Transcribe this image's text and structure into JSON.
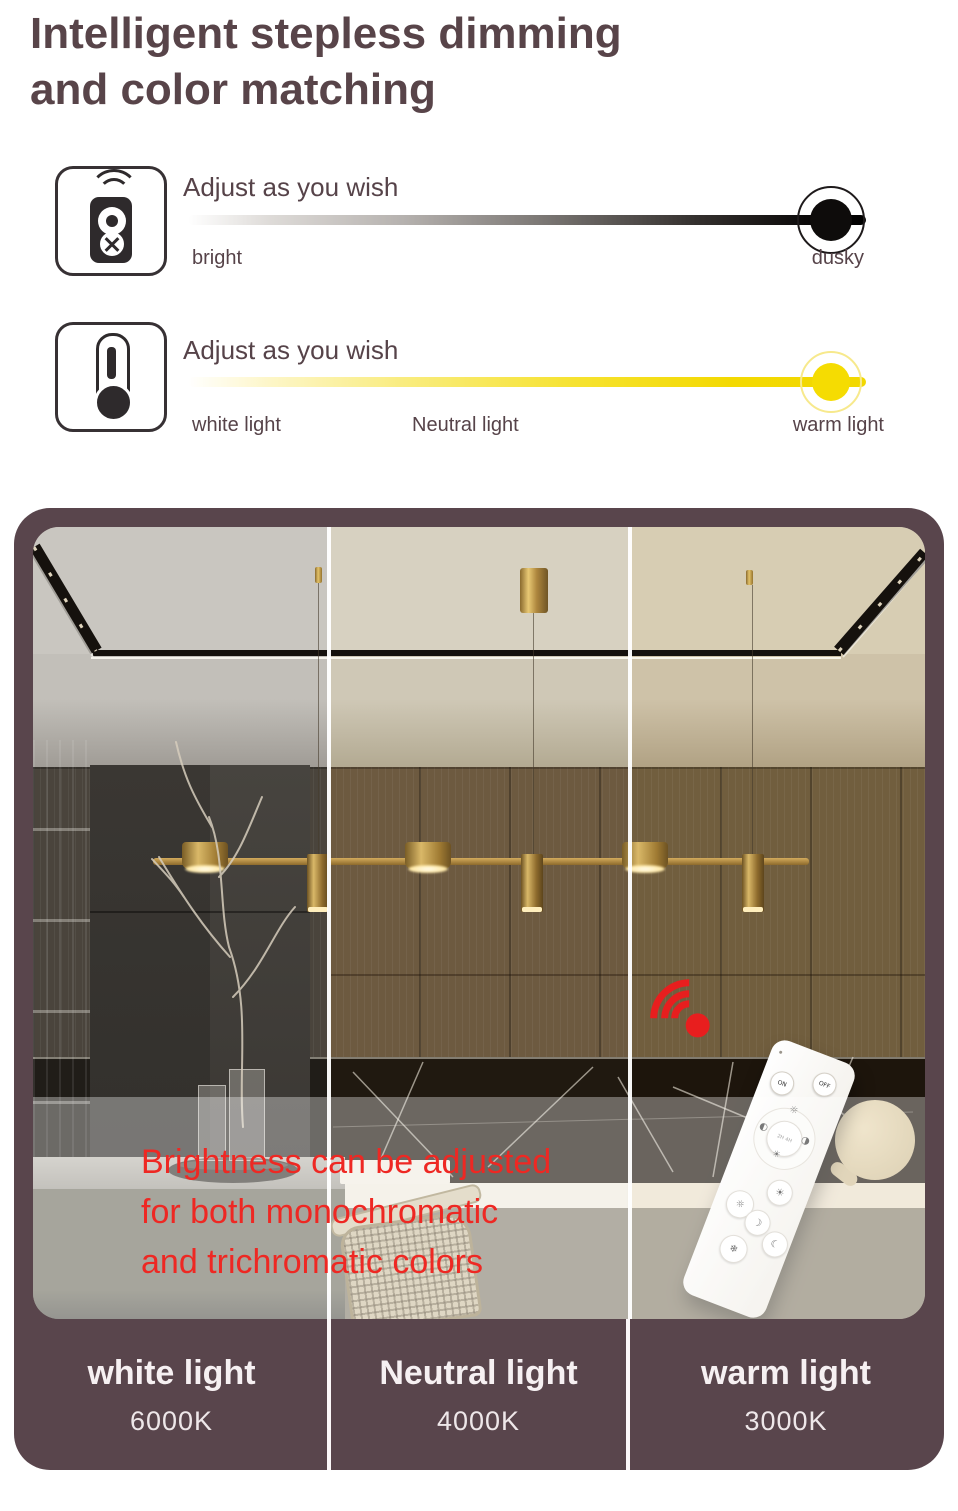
{
  "title": {
    "line1": "Intelligent stepless dimming",
    "line2": "and color matching"
  },
  "dimming_row": {
    "label": "Adjust as you wish",
    "left_label": "bright",
    "right_label": "dusky"
  },
  "color_temp_row": {
    "label": "Adjust as you wish",
    "left_label": "white light",
    "mid_label": "Neutral light",
    "right_label": "warm light"
  },
  "photo": {
    "caption_line1": "Brightness can be adjusted",
    "caption_line2": "for both monochromatic",
    "caption_line3": "and trichromatic colors",
    "remote": {
      "on": "ON",
      "off": "OFF",
      "timer": "2H 4H"
    }
  },
  "columns": [
    {
      "name": "white light",
      "kelvin": "6000K"
    },
    {
      "name": "Neutral light",
      "kelvin": "4000K"
    },
    {
      "name": "warm light",
      "kelvin": "3000K"
    }
  ],
  "colors": {
    "title_text": "#584449",
    "accent_red": "#ee2823",
    "slider_black": "#0e0c0b",
    "slider_yellow": "#f2d800",
    "frame": "#59454c",
    "brass": "#c9a254"
  },
  "icons": [
    "remote-control-icon",
    "thermometer-icon",
    "wifi-icon"
  ]
}
